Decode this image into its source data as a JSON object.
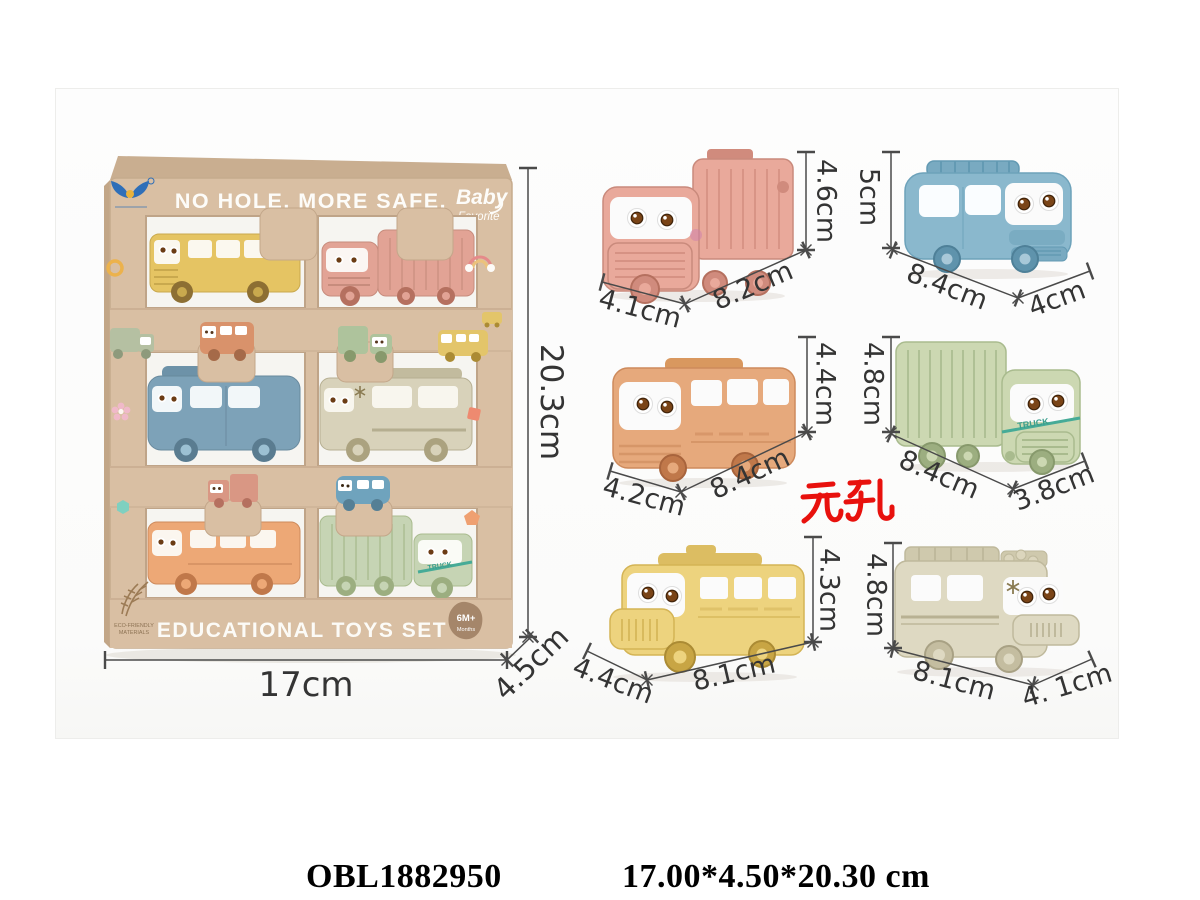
{
  "photo": {
    "box": {
      "tagline": "NO HOLE. MORE SAFE.",
      "brand_line1": "Baby",
      "brand_line2": "Favorite",
      "bottom_title": "EDUCATIONAL TOYS SET",
      "age_badge_line1": "6M+",
      "age_badge_line2": "Months",
      "eco_line1": "ECO-FRIENDLY",
      "eco_line2": "MATERIALS",
      "width_label": "17cm",
      "height_label": "20.3cm",
      "depth_label": "4.5cm"
    },
    "vehicles": [
      {
        "name": "pink dump truck",
        "color": "#e9a99b",
        "height": "4.6cm",
        "length": "8.2cm",
        "depth": "4.1cm"
      },
      {
        "name": "blue van",
        "color": "#8ab8cd",
        "height": "5cm",
        "length": "8.4cm",
        "depth": "4cm"
      },
      {
        "name": "orange city bus",
        "color": "#e6a97c",
        "height": "4.4cm",
        "length": "8.4cm",
        "depth": "4.2cm"
      },
      {
        "name": "green cargo truck",
        "color": "#ccd8b2",
        "height": "4.8cm",
        "length": "8.4cm",
        "depth": "3.8cm",
        "side_text": "TRUCK"
      },
      {
        "name": "yellow school bus",
        "color": "#edd37e",
        "height": "4.3cm",
        "length": "8.1cm",
        "depth": "4.4cm"
      },
      {
        "name": "beige ambulance",
        "color": "#ded9c2",
        "height": "4.8cm",
        "length": "8.1cm",
        "depth": "4. 1cm"
      }
    ],
    "no_hole_text": "无孔",
    "no_hole_color": "#e8110d"
  },
  "footer": {
    "product_code": "OBL1882950",
    "item_size": "17.00*4.50*20.30 cm"
  }
}
